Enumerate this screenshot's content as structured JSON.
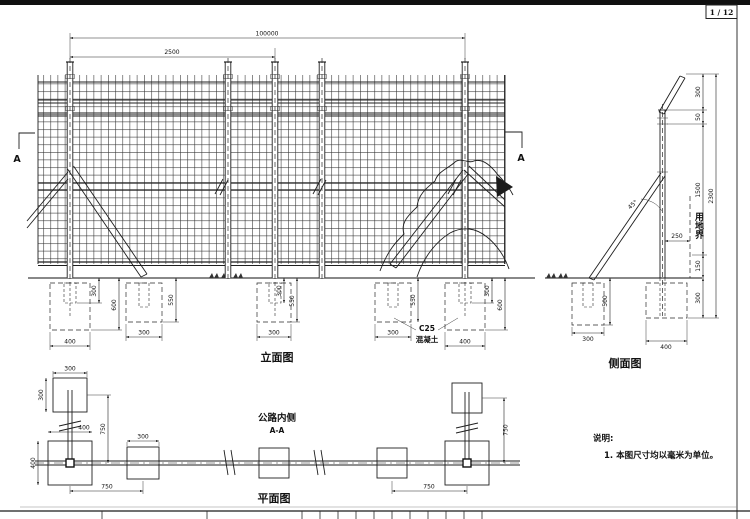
{
  "page": {
    "number": "1 / 12"
  },
  "elevation": {
    "label": "立面图",
    "section_marker_left": "A",
    "section_marker_right": "A",
    "dim_total": "100000",
    "dim_bay": "2500",
    "concrete_grade": "C25",
    "concrete_word": "混凝土",
    "fdn": {
      "p1_stub": "300",
      "p1_depth": "600",
      "p1_width": "400",
      "b1_depth": "550",
      "b1_width": "300",
      "p3_stub": "300",
      "p3_depth": "550",
      "p3_width": "300",
      "b2_depth": "550",
      "b2_width": "300",
      "p5_stub": "300",
      "p5_depth": "600",
      "p5_width": "400"
    }
  },
  "side": {
    "label": "侧面图",
    "boundary": "用地界",
    "angle": "45°",
    "dim_arm": "300",
    "dim_gap": "50",
    "dim_mid": "1500",
    "dim_low": "150",
    "dim_embed": "300",
    "dim_total": "2300",
    "dim_offset": "250",
    "fdn_brace_depth": "500",
    "fdn_brace_width": "300",
    "fdn_post_width": "400"
  },
  "plan": {
    "label": "平面图",
    "road_side": "公路内侧",
    "section": "A-A",
    "anchor_w": "300",
    "anchor_h": "300",
    "post_w": "400",
    "post_h": "400",
    "mid_w": "300",
    "offset_v_left": "750",
    "offset_h_left": "750",
    "offset_v_right": "750",
    "offset_h_right": "750"
  },
  "notes": {
    "title": "说明:",
    "item1": "1. 本图尺寸均以毫米为单位。"
  }
}
